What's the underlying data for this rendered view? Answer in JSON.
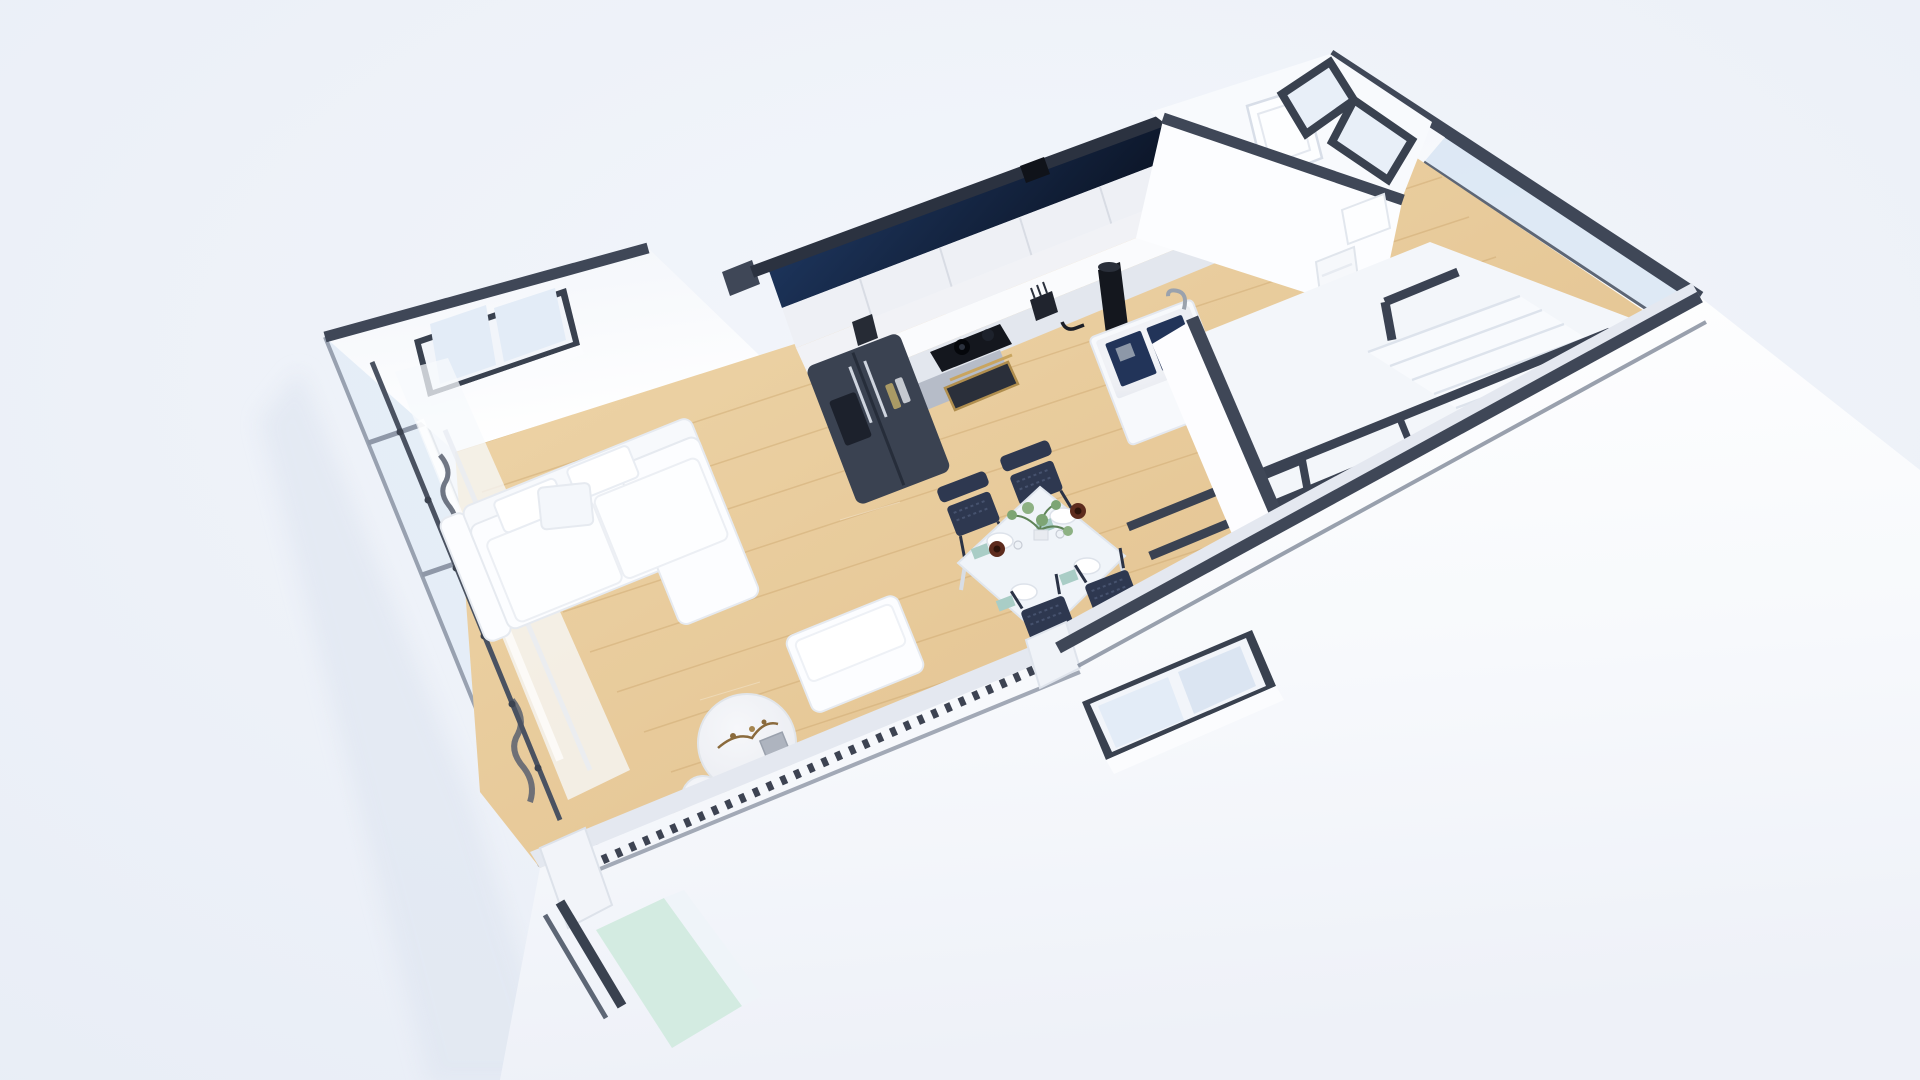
{
  "scene": {
    "kind": "3d-floor-plan-render",
    "view": "isometric-cutaway-top",
    "rooms": [
      {
        "name": "living-room"
      },
      {
        "name": "kitchen"
      },
      {
        "name": "dining-area"
      },
      {
        "name": "hallway"
      },
      {
        "name": "bathroom"
      },
      {
        "name": "stair-hall"
      }
    ],
    "furniture": [
      {
        "name": "sectional-sofa",
        "color_key": "sofa"
      },
      {
        "name": "daybed-ottoman",
        "color_key": "sofa"
      },
      {
        "name": "round-marble-coffee-table",
        "color_key": "marble"
      },
      {
        "name": "round-side-table",
        "color_key": "marble"
      },
      {
        "name": "dining-table",
        "seats": 4,
        "color_key": "table"
      },
      {
        "name": "dining-chair",
        "count": 4,
        "color_key": "chair"
      },
      {
        "name": "refrigerator",
        "style": "side-by-side",
        "color_key": "fridge"
      },
      {
        "name": "kitchen-cabinets-upper",
        "color_key": "cabinet_upper"
      },
      {
        "name": "kitchen-base-cabinets",
        "color_key": "cabinet_gray"
      },
      {
        "name": "cooktop",
        "color_key": "appliance_dark"
      },
      {
        "name": "oven",
        "color_key": "brass"
      },
      {
        "name": "sink-island",
        "basins": 2,
        "color_key": "basin"
      },
      {
        "name": "staircase",
        "color_key": "stair"
      },
      {
        "name": "stair-railing",
        "color_key": "rail"
      },
      {
        "name": "curtains",
        "color_key": "curtain"
      },
      {
        "name": "bathroom-door",
        "state": "open"
      }
    ],
    "table_setting": {
      "plates": 4,
      "teal_napkins": 4,
      "copper_bowls": 2,
      "glasses": 2,
      "centerpiece": "green-plant"
    }
  },
  "colors": {
    "background": "#edf1f8",
    "wall_face": "#fdfdfe",
    "wall_shade": "#eef1f7",
    "wall_cap": "#3f4757",
    "cap_dark": "#2b3240",
    "cut_strip": "#e4e8f0",
    "navy_top": "#23406f",
    "navy_bottom": "#0a1222",
    "wood_light": "#efd7ab",
    "wood_dark": "#e0bd89",
    "plank_line": "#cda76f",
    "glass": "#e3ecf7",
    "glass_band": "#d8e5f3",
    "glass_mint": "#cfeade",
    "curtain": "#f7f9fc",
    "curtain_fold": "#596070",
    "cabinet_upper": "#eef0f5",
    "cabinet_gray": "#b6bcc8",
    "counter": "#fafbfd",
    "marble": "#f1f2f6",
    "fridge": "#3a4251",
    "appliance_dark": "#14171e",
    "brass": "#b08e4e",
    "basin": "#223459",
    "chair": "#2e3850",
    "table": "#f0f4f9",
    "napkin": "#a9cdc6",
    "bowl": "#5d2b1d",
    "plant": "#7da574",
    "rail": "#3a4252",
    "stair": "#f3f6fa",
    "sofa": "#fcfdff",
    "shadow": "#dce3ef",
    "mullion": "#98a1b0",
    "teeth": "#3d4352"
  }
}
